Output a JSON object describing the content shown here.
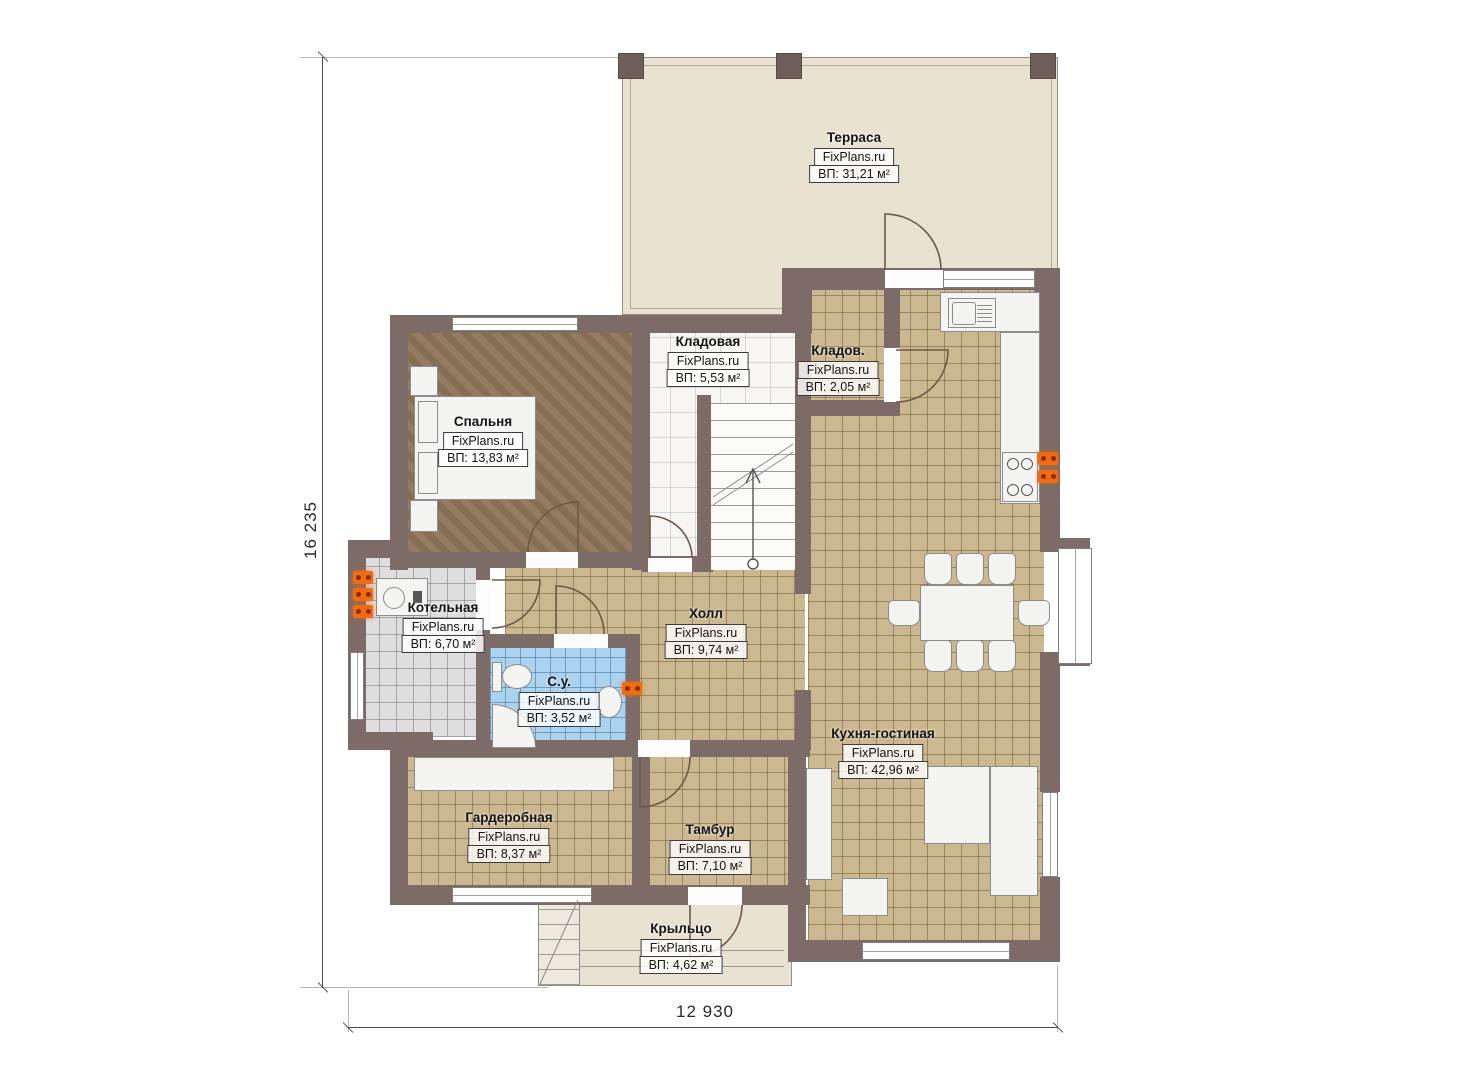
{
  "title": "План первого этажа",
  "watermark": "FixPlans.ru",
  "dimensions": {
    "height_label": "16 235",
    "width_label": "12 930"
  },
  "rooms": {
    "terrace": {
      "name": "Терраса",
      "area": "ВП: 31,21 м²"
    },
    "bedroom": {
      "name": "Спальня",
      "area": "ВП: 13,83 м²"
    },
    "storage_large": {
      "name": "Кладовая",
      "area": "ВП: 5,53 м²"
    },
    "storage_small": {
      "name": "Кладов.",
      "area": "ВП: 2,05 м²"
    },
    "boiler": {
      "name": "Котельная",
      "area": "ВП: 6,70 м²"
    },
    "hall": {
      "name": "Холл",
      "area": "ВП: 9,74 м²"
    },
    "bathroom": {
      "name": "С.у.",
      "area": "ВП: 3,52 м²"
    },
    "kitchen_living": {
      "name": "Кухня-гостиная",
      "area": "ВП: 42,96 м²"
    },
    "wardrobe": {
      "name": "Гардеробная",
      "area": "ВП: 8,37 м²"
    },
    "vestibule": {
      "name": "Тамбур",
      "area": "ВП: 7,10 м²"
    },
    "porch": {
      "name": "Крыльцо",
      "area": "ВП: 4,62 м²"
    }
  },
  "colors": {
    "wall": "#7c6b66",
    "floor_tile_tan": "#cbb890",
    "floor_wood_brown": "#8d7557",
    "floor_tile_gray": "#dedede",
    "floor_tile_blue": "#abd2ee",
    "floor_terrace_beige": "#e9e1d2",
    "outlet_orange": "#ef6c12"
  }
}
